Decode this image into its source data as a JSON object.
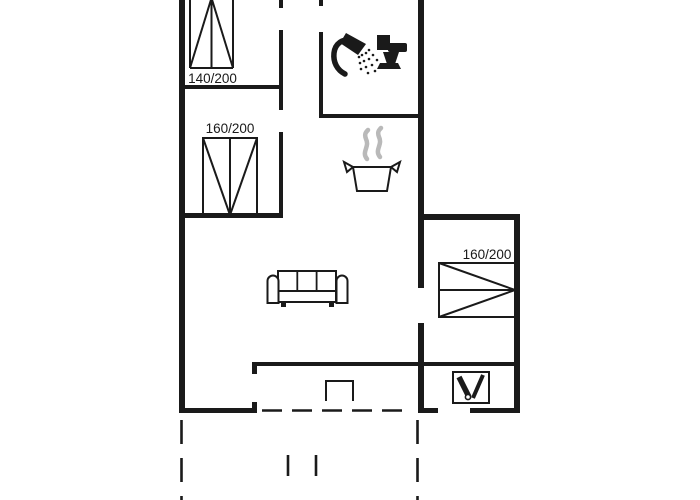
{
  "floor_plan": {
    "labels": {
      "bed_top_left": "140/200",
      "bed_mid_left": "160/200",
      "bed_right": "160/200"
    },
    "colors": {
      "line": "#1a1a1a",
      "steam": "#b9b9b9",
      "background": "#ffffff"
    },
    "icons": [
      {
        "name": "shower-icon"
      },
      {
        "name": "toilet-icon"
      },
      {
        "name": "cooking-pot-icon"
      },
      {
        "name": "steam-icon"
      },
      {
        "name": "sofa-icon"
      },
      {
        "name": "wood-stove-icon"
      },
      {
        "name": "terrace-step-icon"
      }
    ]
  }
}
